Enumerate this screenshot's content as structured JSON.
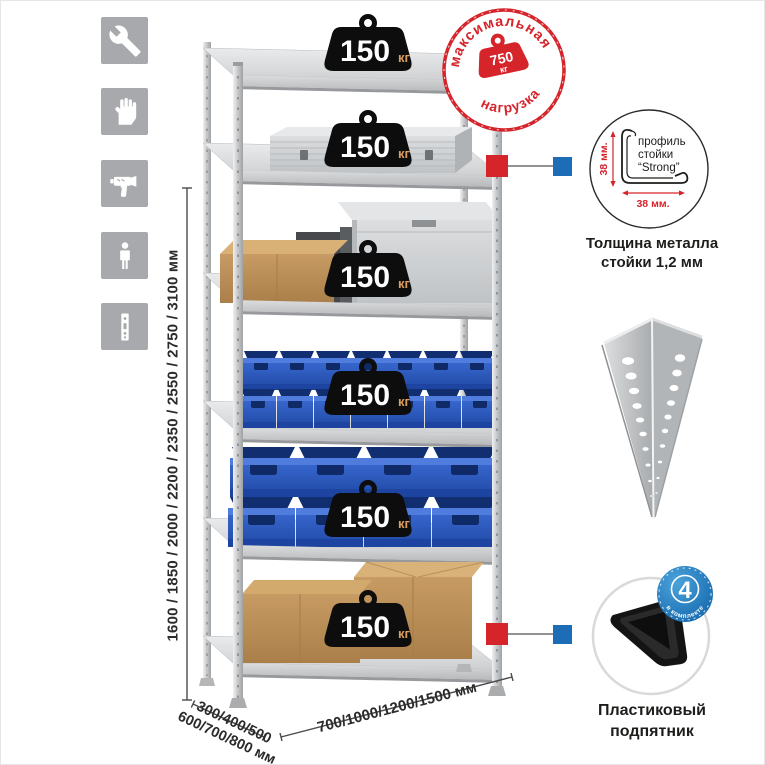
{
  "colors": {
    "accent_red": "#d6242b",
    "connector_blue": "#1d6db6",
    "badge_blue": "#1b7ac1",
    "icon_gray": "#a7a9ac",
    "bin_blue": "#2e5ec8",
    "dimension_text": "#2b2b2b"
  },
  "left_icons": {
    "items": [
      "wrench",
      "gloves",
      "drill",
      "person",
      "rack-post"
    ]
  },
  "height_dimension": {
    "label": "1600 / 1850 / 2000 / 2200 / 2350 / 2550 / 2750 / 3100 мм"
  },
  "depth_dimension": {
    "line1": "300/400/500",
    "line2": "600/700/800 мм"
  },
  "width_dimension": {
    "label": "700/1000/1200/1500 мм"
  },
  "shelf_weights": [
    {
      "value": "150",
      "unit": "кг"
    },
    {
      "value": "150",
      "unit": "кг"
    },
    {
      "value": "150",
      "unit": "кг"
    },
    {
      "value": "150",
      "unit": "кг"
    },
    {
      "value": "150",
      "unit": "кг"
    },
    {
      "value": "150",
      "unit": "кг"
    }
  ],
  "max_load_stamp": {
    "arc_top": "максимальная",
    "arc_bottom": "нагрузка",
    "value": "750",
    "unit": "кг"
  },
  "profile_callout": {
    "label_line1": "профиль",
    "label_line2": "стойки",
    "label_line3": "“Strong”",
    "vertical_dim": "38 мм.",
    "horizontal_dim": "38 мм.",
    "caption_line1": "Толщина металла",
    "caption_line2": "стойки 1,2 мм"
  },
  "foot_callout": {
    "badge_value": "4",
    "badge_arc": "в комплекте",
    "caption_line1": "Пластиковый",
    "caption_line2": "подпятник"
  }
}
